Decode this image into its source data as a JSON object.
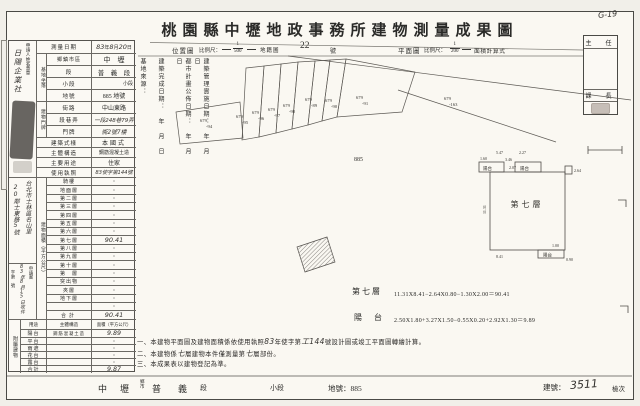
{
  "corner_note": "G-19",
  "title": "桃園縣中壢地政事務所建物測量成果圖",
  "subtitle": {
    "location_label": "位置圖",
    "scale_label": "比例尺：",
    "loc_frac_num": "1",
    "loc_frac_den": "500",
    "cadastral_label": "地籍圖",
    "sheet_no": "22",
    "sheet_no_unit": "號",
    "plan_label": "平面圖",
    "plan_scale_label": "比例尺：",
    "plan_frac_num": "1",
    "plan_frac_den": "200",
    "calc_label": "面積計算式"
  },
  "approval": {
    "director": "主　任",
    "section_chief": "課　長"
  },
  "site_info_columns": {
    "c0": "基地來源：",
    "c1": "建築完成日期：　年　月　日",
    "c2": "都市計畫公佈日期：　年　月　日",
    "c3": "建築管理實施日期：　年　月　日"
  },
  "applicant": {
    "header": "申請人姓名蓋章",
    "name": "日陽企業社",
    "address_line1": "台北市士林區名山里",
    "address_line2": "20鄰士東路5號",
    "receipt_label": "申請書",
    "receipt_date": "83年8月15日收件",
    "receipt_no": "字第　號"
  },
  "survey": {
    "label": "測量日期",
    "year": "83",
    "year_unit": "年",
    "month": "8",
    "month_unit": "月",
    "day": "20",
    "day_unit": "日"
  },
  "location_group_label": "基地坐落",
  "location_rows": [
    {
      "label": "鄉鎮市區",
      "value": "中　壢"
    },
    {
      "label": "段",
      "value": "普　義　段"
    },
    {
      "label": "小段",
      "value": "小段"
    },
    {
      "label": "地號",
      "value": "885 地號"
    }
  ],
  "address_group_label": "建物門牌",
  "address_rows": [
    {
      "label": "街路",
      "value": "中山東路"
    },
    {
      "label": "段巷弄",
      "value": "一段248巷79弄"
    },
    {
      "label": "門牌",
      "value": "衖2號7樓"
    }
  ],
  "building_rows": [
    {
      "label": "建築式樣",
      "value": "本國式"
    },
    {
      "label": "主體構造",
      "value": "鋼筋混凝土造"
    },
    {
      "label": "主要用途",
      "value": "住家"
    },
    {
      "label": "使用執照",
      "value": "83使字第144號"
    }
  ],
  "floor_section": {
    "group_label": "建物面積（平方公尺）",
    "rows": [
      {
        "label": "騎樓",
        "value": "・"
      },
      {
        "label": "地面層",
        "value": "・"
      },
      {
        "label": "第二層",
        "value": "・"
      },
      {
        "label": "第三層",
        "value": "・"
      },
      {
        "label": "第四層",
        "value": "・"
      },
      {
        "label": "第五層",
        "value": "・"
      },
      {
        "label": "第六層",
        "value": "・"
      },
      {
        "label": "第七層",
        "value": "90.41"
      },
      {
        "label": "第八層",
        "value": "・"
      },
      {
        "label": "第九層",
        "value": "・"
      },
      {
        "label": "第十層",
        "value": "・"
      },
      {
        "label": "第　層",
        "value": "・"
      },
      {
        "label": "突出物",
        "value": "・"
      },
      {
        "label": "夾層",
        "value": "・"
      },
      {
        "label": "地下層",
        "value": "・"
      },
      {
        "label": "",
        "value": "・"
      },
      {
        "label": "合計",
        "value": "90.41"
      }
    ]
  },
  "attached_section": {
    "group_label": "附屬建物",
    "headers": {
      "use": "用途",
      "structure": "主體構造",
      "area": "面積（平方公尺）"
    },
    "rows": [
      {
        "use": "陽台",
        "structure": "鋼筋混凝土造",
        "area": "9.89"
      },
      {
        "use": "平台",
        "structure": "",
        "area": "・"
      },
      {
        "use": "雨遮",
        "structure": "",
        "area": "・"
      },
      {
        "use": "花台",
        "structure": "",
        "area": "・"
      },
      {
        "use": "露台",
        "structure": "",
        "area": "・"
      },
      {
        "use": "合計",
        "structure": "",
        "area": "9.87"
      }
    ]
  },
  "map": {
    "parcels": [
      {
        "t": "679",
        "b": "-94"
      },
      {
        "t": "679",
        "b": "-95"
      },
      {
        "t": "679",
        "b": "-96"
      },
      {
        "t": "679",
        "b": "-97"
      },
      {
        "t": "679",
        "b": "-98"
      },
      {
        "t": "679",
        "b": "-89"
      },
      {
        "t": "679",
        "b": "-90"
      },
      {
        "t": "679",
        "b": "-91"
      }
    ],
    "road_parcel": {
      "t": "679",
      "b": "-163"
    },
    "site_number": "885"
  },
  "plan": {
    "room_label": "第七層",
    "balcony_label": "陽台",
    "dims": {
      "d1": "1.60",
      "d2": "5.47",
      "d3": "2.27",
      "d4": "3.46",
      "d5": "2.07",
      "d6": "2.64",
      "d7": "1.00",
      "d8": "0.90",
      "d9": "8.41",
      "d10": "11.31"
    }
  },
  "formulas": [
    {
      "name": "第七層",
      "expr": "11.31X8.41−2.64X0.80−1.30X2.00＝90.41"
    },
    {
      "name": "陽　台",
      "expr": "2.50X1.80+3.27X1.50−0.55X0.20+2.92X1.30＝9.89"
    }
  ],
  "notes": [
    {
      "pre": "一、本建物平面圖及建物面積係依使用執照",
      "hw1": "83",
      "mid1": "年使字第",
      "hw2": "工144",
      "post": "號設計圖或竣工平面圖轉繪計算。"
    },
    {
      "pre": "二、本建物係",
      "hw1": "七",
      "mid1": "層建物本件僅測量第",
      "hw2": "七",
      "post": "層部份。"
    },
    {
      "pre": "三、本成果表以建物登記為準。",
      "hw1": "",
      "mid1": "",
      "hw2": "",
      "post": ""
    }
  ],
  "footer": {
    "district": "中　壢",
    "district_unit1": "鄉",
    "district_unit2": "市",
    "section": "普　義",
    "section_unit": "段",
    "subsection": "小段",
    "lot_label": "地號：",
    "lot_no": "885",
    "building_label": "建號：",
    "building_no": "3511",
    "check_label": "檢次"
  }
}
